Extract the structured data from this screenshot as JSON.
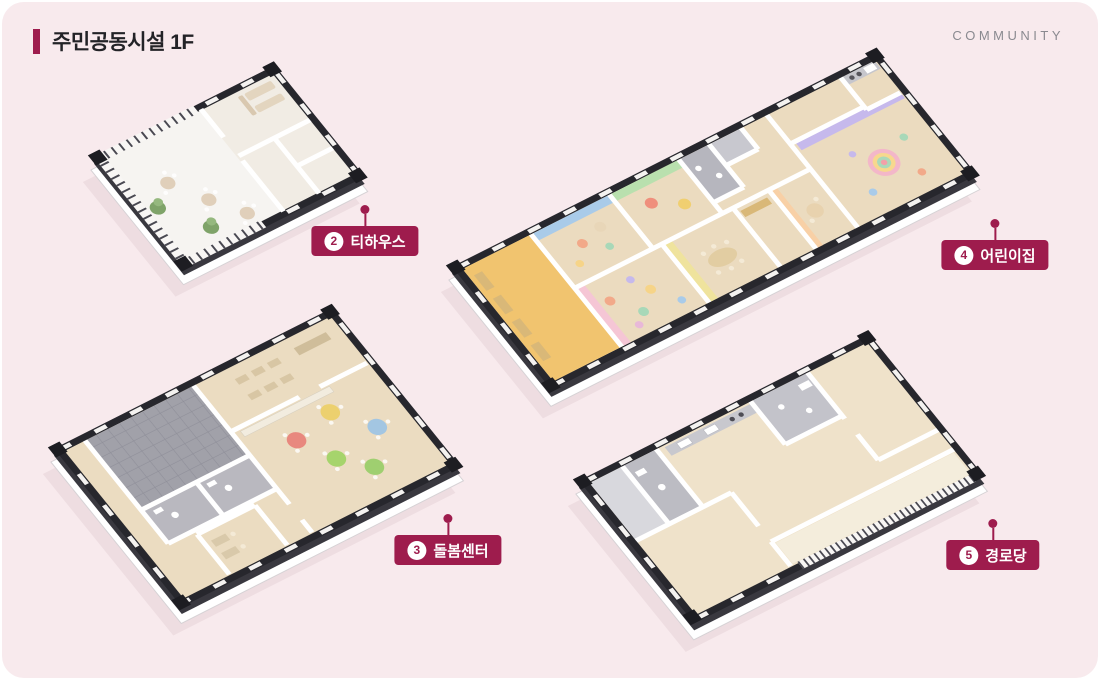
{
  "page": {
    "title": "주민공동시설 1F",
    "corner_text": "COMMUNITY"
  },
  "labels": [
    {
      "number": "2",
      "name": "티하우스"
    },
    {
      "number": "3",
      "name": "돌봄센터"
    },
    {
      "number": "4",
      "name": "어린이집"
    },
    {
      "number": "5",
      "name": "경로당"
    }
  ],
  "buildings": [
    {
      "key": "tea-house",
      "label_number": "2",
      "label_name": "티하우스"
    },
    {
      "key": "care-center",
      "label_number": "3",
      "label_name": "돌봄센터"
    },
    {
      "key": "daycare",
      "label_number": "4",
      "label_name": "어린이집"
    },
    {
      "key": "senior-center",
      "label_number": "5",
      "label_name": "경로당"
    }
  ],
  "palette": {
    "background": "#f8eaed",
    "accent": "#9e1c4d",
    "wall_dark": "#27272d",
    "floor_wood": "#ebdbbf",
    "floor_light": "#f6f4f1",
    "tile_gray": "#a1a1a9",
    "room_accents": {
      "blue": "#a9cbe9",
      "green": "#b9e0ae",
      "pink": "#f5c6d5",
      "yellow": "#efe39d",
      "orange": "#f8d0a6",
      "purple": "#c6b9ec",
      "cubby_yellow": "#f1c46f"
    }
  }
}
